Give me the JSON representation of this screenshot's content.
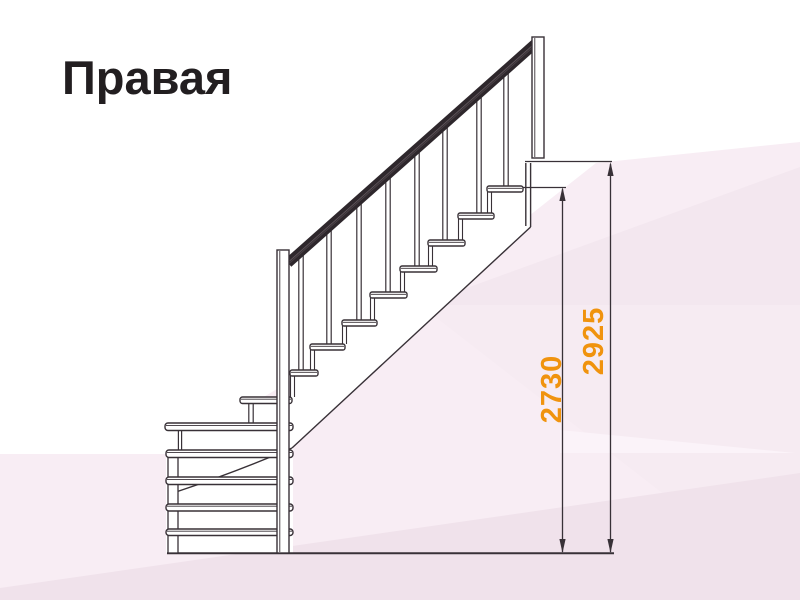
{
  "title": "Правая",
  "diagram": {
    "type": "staircase-side-view-right-turn-with-winder-steps",
    "dimension_labels": {
      "flight_height": "2730",
      "total_height": "2925"
    },
    "colors": {
      "dimension_text": "#f0930e",
      "line": "#383137",
      "handrail": "#2e272c",
      "background_tint": "#f8edf4"
    }
  }
}
